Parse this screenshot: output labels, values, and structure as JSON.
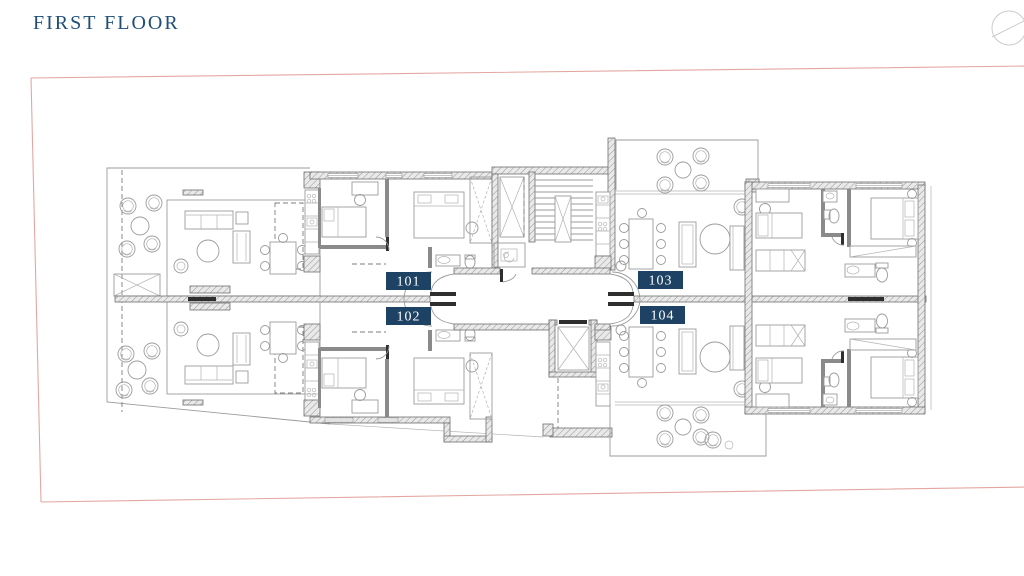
{
  "page": {
    "title": "FIRST FLOOR"
  },
  "header": {
    "north_indicator_icon": "circle-with-diagonal-line"
  },
  "colors": {
    "title": "#1f4e79",
    "badge_bg": "#1d4263",
    "badge_text": "#ffffff",
    "site_boundary": "#e3a7a2",
    "wall": "#6f6f6f",
    "drawing_line": "#9b9b9b"
  },
  "plan": {
    "units": [
      {
        "label": "101"
      },
      {
        "label": "102"
      },
      {
        "label": "103"
      },
      {
        "label": "104"
      }
    ]
  }
}
